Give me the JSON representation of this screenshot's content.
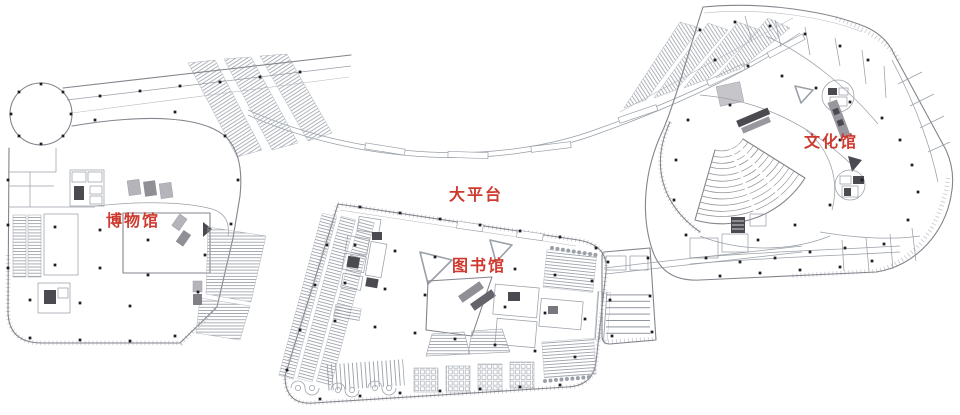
{
  "page": {
    "type": "architectural-floor-plan",
    "background": "#ffffff"
  },
  "labels": {
    "platform": "大平台",
    "museum": "博物馆",
    "library": "图书馆",
    "culture_center": "文化馆"
  },
  "colors": {
    "label_red": "#ce3a2f",
    "wall_gray": "#84848c",
    "line_gray": "#9aa0a8",
    "column_dot": "#1d1d22",
    "fill_gray": "#b4b4ba",
    "dark_fill": "#4a4a50"
  }
}
